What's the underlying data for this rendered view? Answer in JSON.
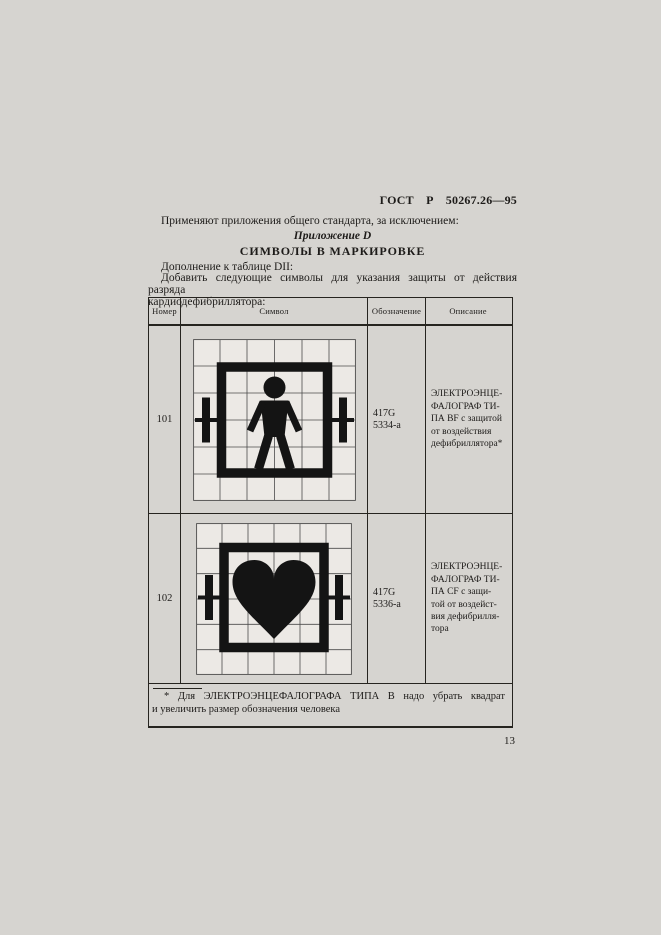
{
  "doc": {
    "standard_ref": "ГОСТ Р 50267.26—95",
    "intro": "Применяют приложения общего стандарта, за исключением:",
    "appendix_label": "Приложение D",
    "appendix_title": "СИМВОЛЫ В МАРКИРОВКЕ",
    "supplement_note": "Дополнение к таблице DII:",
    "add_instruction_line1": "Добавить следующие символы для указания защиты от действия разряда",
    "add_instruction_line2": "кардиодефибриллятора:",
    "page_number": "13"
  },
  "table": {
    "headers": {
      "number": "Номер",
      "symbol": "Символ",
      "designation": "Обозначение",
      "description": "Описание"
    },
    "rows": [
      {
        "number": "101",
        "symbol_name": "defibrillation-proof-type-BF-applied-part-symbol",
        "designation": [
          "417G",
          "5334-a"
        ],
        "description_lines": [
          "ЭЛЕКТРОЭНЦЕ-",
          "ФАЛОГРАФ ТИ-",
          "ПА BF с защитой",
          "от воздействия",
          "дефибриллятора*"
        ]
      },
      {
        "number": "102",
        "symbol_name": "defibrillation-proof-type-CF-applied-part-symbol",
        "designation": [
          "417G",
          "5336-a"
        ],
        "description_lines": [
          "ЭЛЕКТРОЭНЦЕ-",
          "ФАЛОГРАФ ТИ-",
          "ПА CF с защи-",
          "той от воздейст-",
          "вия дефибрилля-",
          "тора"
        ]
      }
    ],
    "footnote_line1": "* Для ЭЛЕКТРОЭНЦЕФАЛОГРАФА ТИПА В надо убрать квадрат",
    "footnote_line2": "и увеличить размер обозначения человека"
  },
  "colors": {
    "paper": "#d6d4d0",
    "ink": "#1d1b19",
    "symbol_paper": "#ece9e5",
    "symbol_ink": "#141414"
  }
}
